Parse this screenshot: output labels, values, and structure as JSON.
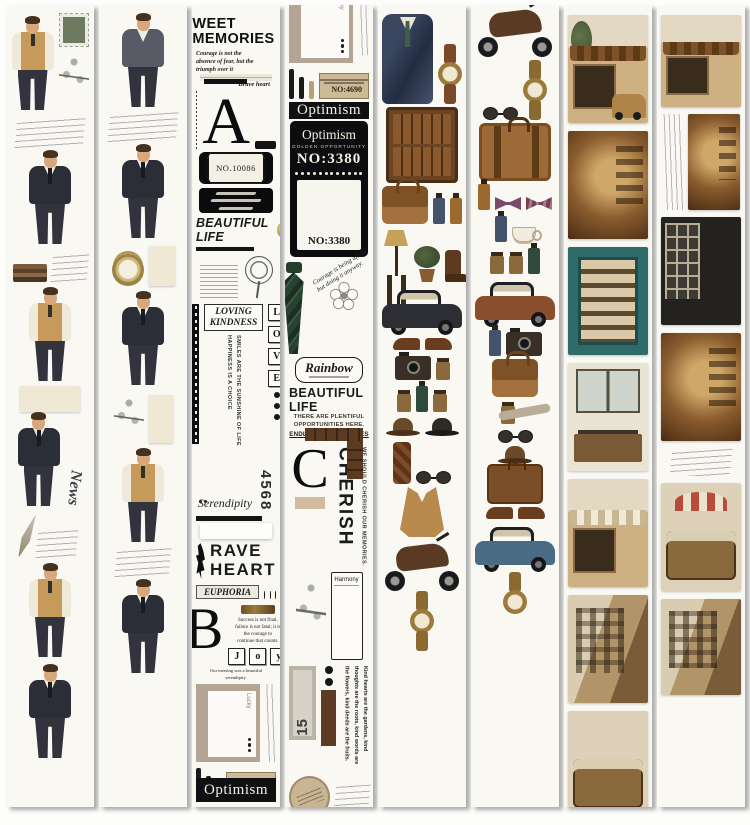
{
  "meta": {
    "description_tags": {
      "product": "vintage washi tape strips",
      "strip_count": 8
    },
    "colors": {
      "page_bg": "#fdfdfc",
      "tape_bg": "#f9f8f3",
      "ink_black": "#101012",
      "tan": "#cdbb97",
      "leather_brown": "#7a4e22",
      "suit_navy": "#2b2d37",
      "vest_tan": "#c59a5a",
      "tie_green": "#27422f",
      "teal_cabinet": "#2e6b69",
      "gold": "#b98a3e"
    }
  },
  "t1": {
    "news": "News"
  },
  "t3": {
    "header_line1": "WEET",
    "header_line2": "MEMORIES",
    "quote": "Courage is not the absence of fear, but the triumph over it",
    "brave": "Brave heart",
    "letter_a": "A",
    "label_no": "NO.10086",
    "beautiful_life": "BEAUTIFUL LIFE",
    "loving_line1": "LOVING",
    "loving_line2": "KINDNESS",
    "vert_happiness": "HAPPINESS IS A CHOICE",
    "vert_smiles": "SMILES ARE THE SUNSHINE OF LIFE",
    "vert_perseverance": "PERSEVERANCE IS THE KEY TO SUCCESS",
    "love": [
      "L",
      "O",
      "V",
      "E"
    ],
    "serendipity": "Serendipity",
    "number": "4568",
    "rave_line1": "RAVE",
    "rave_line2": "HEART",
    "euphoria": "EUPHORIA",
    "letter_b": "B",
    "success_quote": "Success is not final, failure is not fatal; it is the courage to continue that counts.",
    "joy": [
      "J",
      "o",
      "y"
    ],
    "meeting": "Our meeting was a beautiful serendipity."
  },
  "lucky_block": {
    "lucky": "Lucky",
    "no4690": "NO:4690",
    "optimism": "Optimism"
  },
  "t4": {
    "ticket_title": "Optimism",
    "golden": "GOLDEN OPPORTUNITY",
    "no3380": "NO:3380",
    "courage": "Courage is being afraid but doing it anyway.",
    "rainbow": "Rainbow",
    "beautiful_life": "BEAUTIFUL LIFE",
    "plentiful": "THERE ARE PLENTIFUL OPPORTUNITIES HERE.",
    "endless": "ENDLESS POSSIBILITIES",
    "letter_c": "C",
    "cherish": "CHERISH",
    "cherish_sub": "WE SHOULD CHERISH OUR MEMORIES.",
    "harmony": "Harmony",
    "fifteen": "15",
    "kind_quote": "Kind hearts are the gardens, kind thoughts are the roots, kind words are the flowers, kind deeds are the fruits."
  }
}
